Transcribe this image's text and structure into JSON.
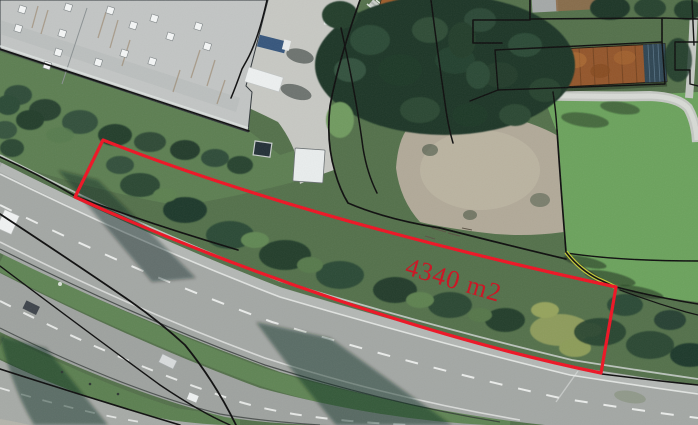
{
  "map": {
    "view_type": "aerial-orthophoto-with-cadastral-overlay",
    "parcel": {
      "area_label": "4340 m2",
      "outline_color": "#ee1323",
      "label_color": "#cc1120",
      "outline_path": "M 103 140 Q 300 218 616 287 L 601 373 C 440 340 240 272 75 197 Z"
    },
    "boundaries": {
      "cadastral_line_color": "#0d0d0d",
      "highlighted_boundary_color": "#c3c937"
    }
  }
}
